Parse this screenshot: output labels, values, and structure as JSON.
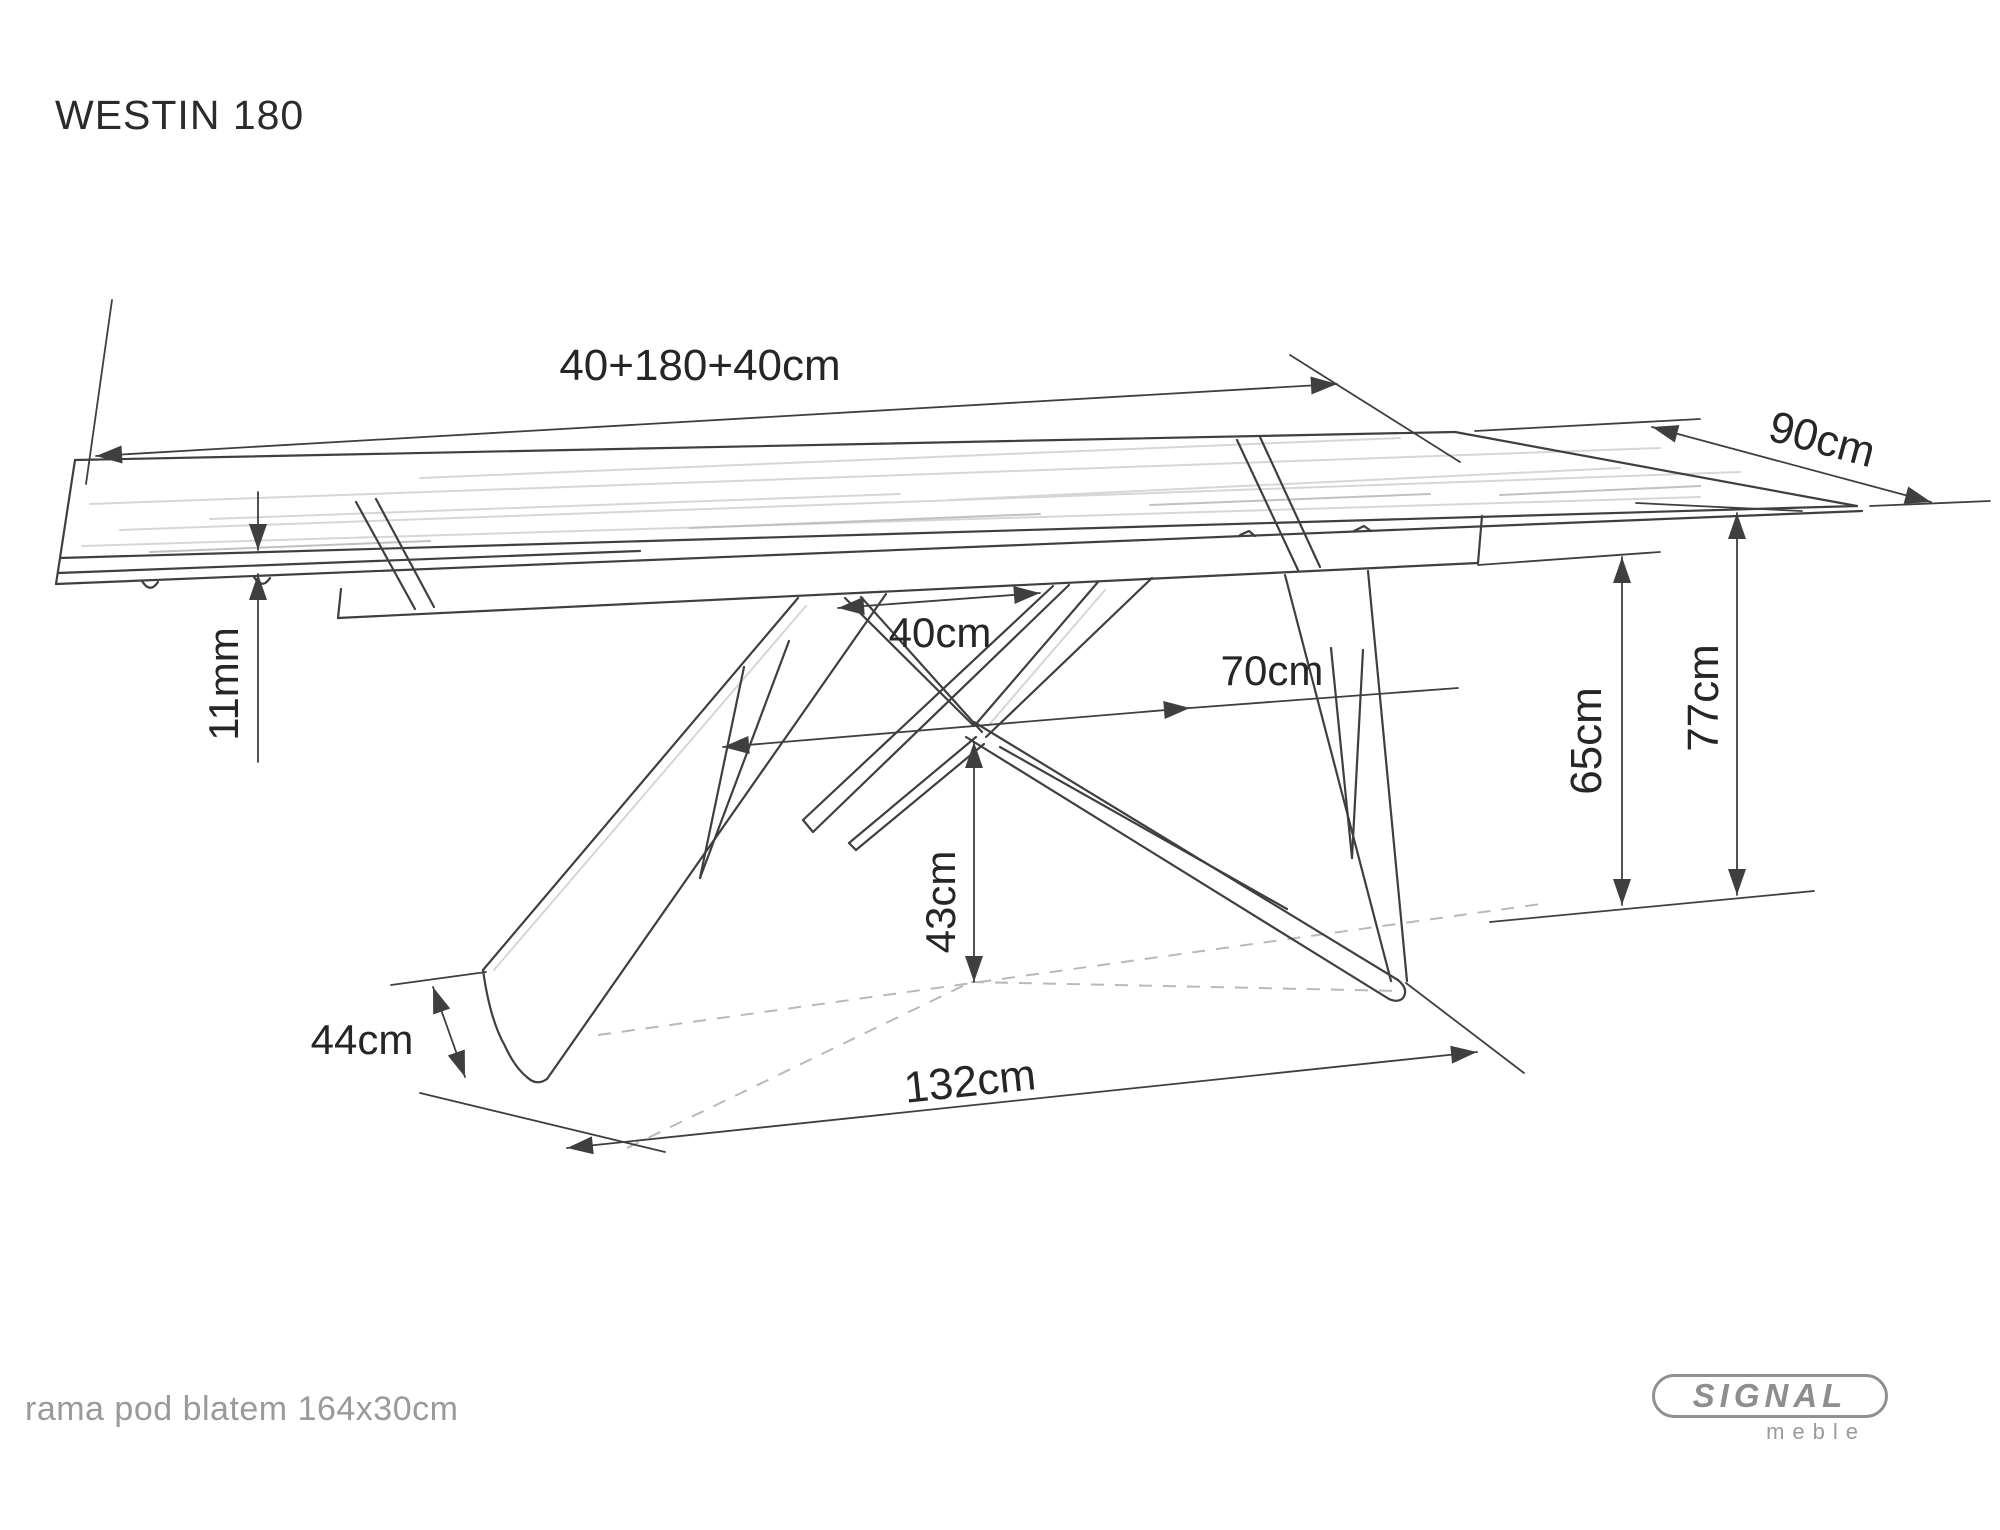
{
  "title": "WESTIN 180",
  "dimensions": {
    "length_total": "40+180+40cm",
    "width": "90cm",
    "top_thickness": "11mm",
    "leg_top_span": "40cm",
    "leg_mid_span": "70cm",
    "underframe_height": "65cm",
    "table_height": "77cm",
    "leg_cross_height": "43cm",
    "foot_depth": "44cm",
    "base_span": "132cm"
  },
  "footer": {
    "note": "rama pod blatem 164x30cm"
  },
  "logo": {
    "brand": "SIGNAL",
    "sub": "meble"
  },
  "colors": {
    "background": "#ffffff",
    "line": "#3f3f3f",
    "dashed": "#b9b9b9",
    "grain": "#d6d6d6",
    "grain_dark": "#c0c0c0",
    "label": "#262626",
    "note": "#9a9a9a",
    "logo": "#8e8e8e"
  }
}
